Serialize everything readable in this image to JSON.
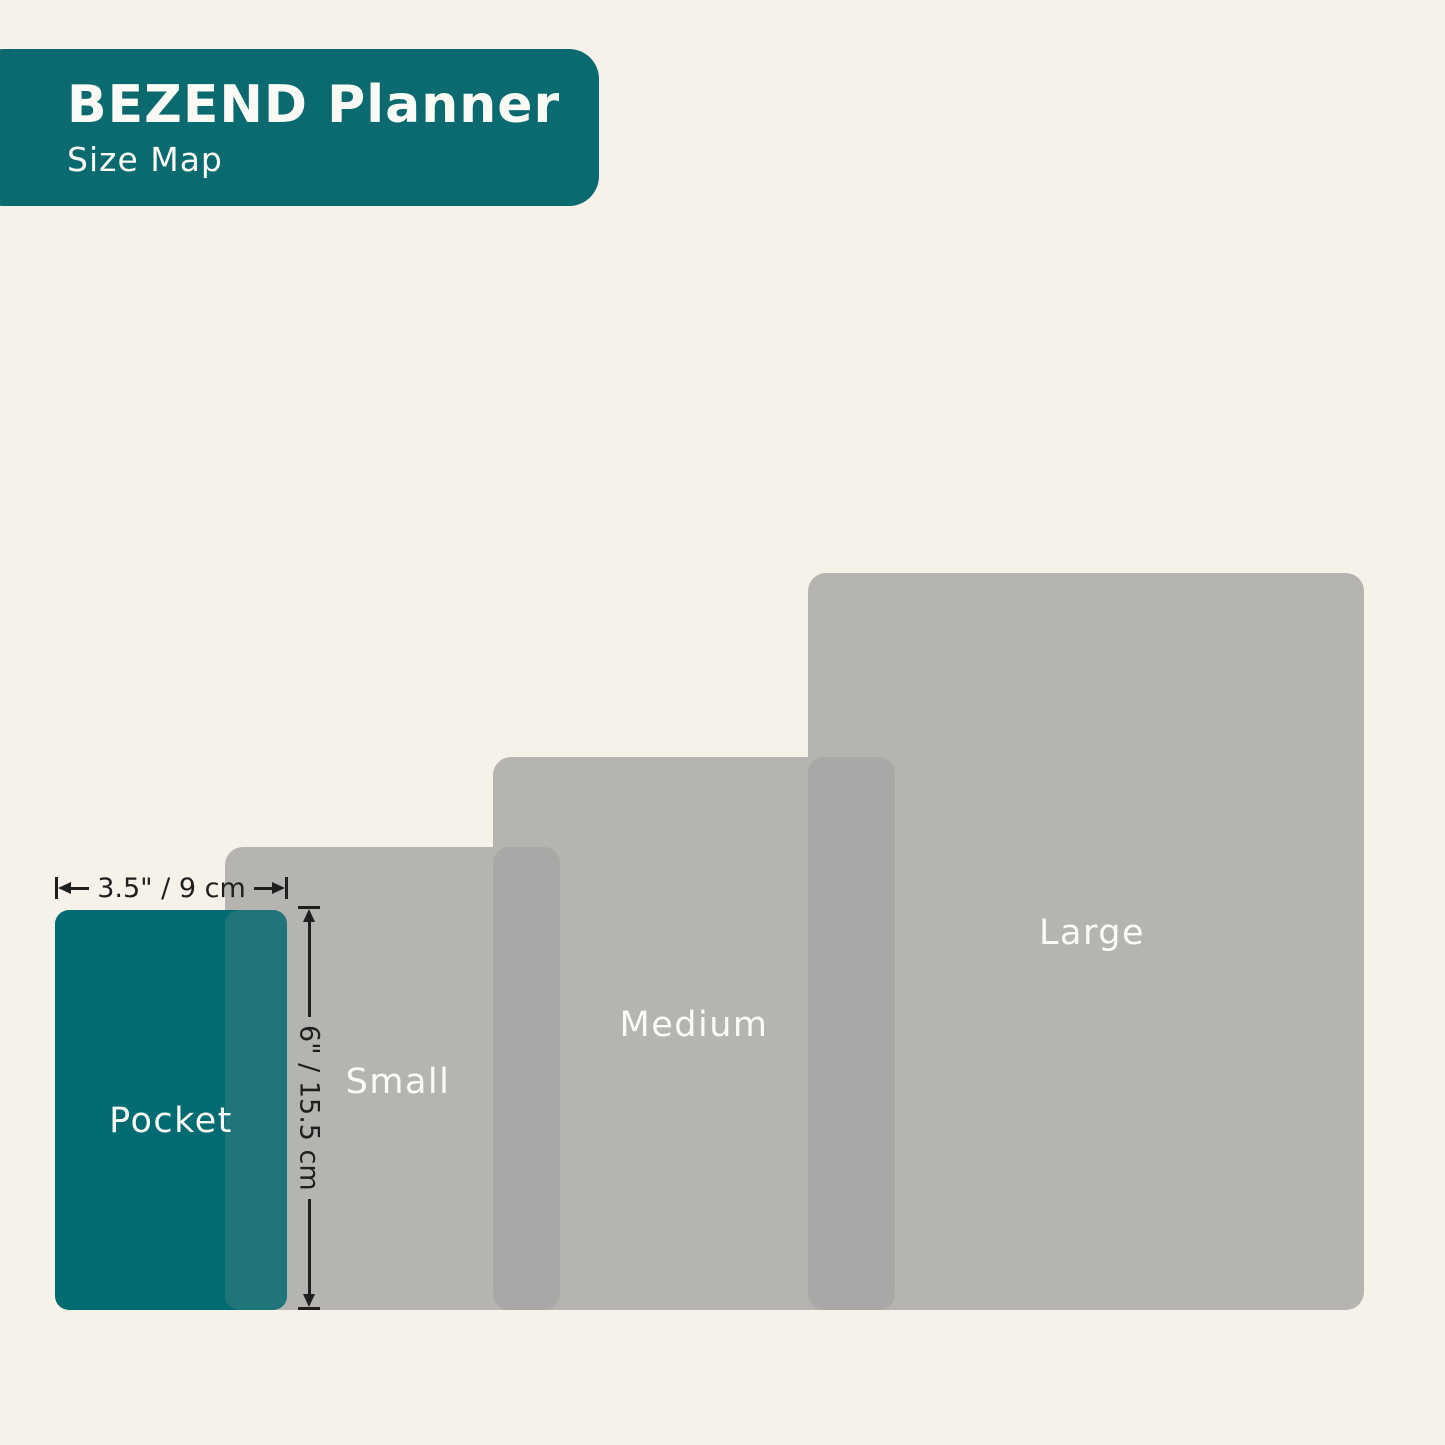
{
  "header": {
    "title": "BEZEND Planner",
    "subtitle": "Size Map"
  },
  "sizes": [
    {
      "label": "Pocket",
      "highlighted": true
    },
    {
      "label": "Small"
    },
    {
      "label": "Medium"
    },
    {
      "label": "Large"
    }
  ],
  "pocket_dimensions": {
    "width": "3.5\" / 9 cm",
    "height": "6\" / 15.5 cm"
  },
  "colors": {
    "background": "#F6F2E9",
    "brand_teal": "#0B6A70",
    "pocket_fill": "#016B72",
    "pocket_overlap": "#20757A",
    "gray_fill": "#B6B4B1",
    "gray_overlap": "#A9A8A6",
    "label_text": "#FAFBF5",
    "dimension_ink": "#1F1F1F"
  }
}
